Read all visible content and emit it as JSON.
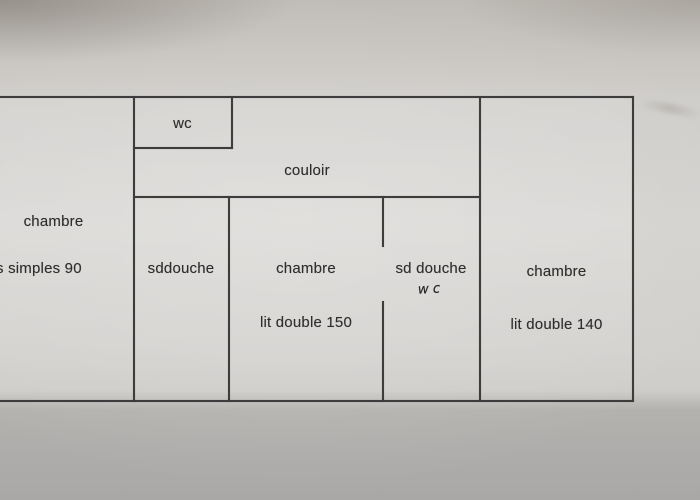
{
  "colors": {
    "paper": "#d5d3d0",
    "paper_top": "#c9c5c0",
    "paper_bottom": "#afadab",
    "line": "#3d3d3d",
    "text": "#2e2e2e"
  },
  "plan": {
    "room_left": {
      "label": "chambre",
      "detail": "s simples 90"
    },
    "wc": {
      "label": "wc"
    },
    "couloir": {
      "label": "couloir"
    },
    "shower_left": {
      "label": "sddouche"
    },
    "room_center": {
      "label": "chambre",
      "detail": "lit double 150"
    },
    "shower_right": {
      "label": "sd douche",
      "note": "wc"
    },
    "room_right": {
      "label": "chambre",
      "detail": "lit double 140"
    }
  }
}
